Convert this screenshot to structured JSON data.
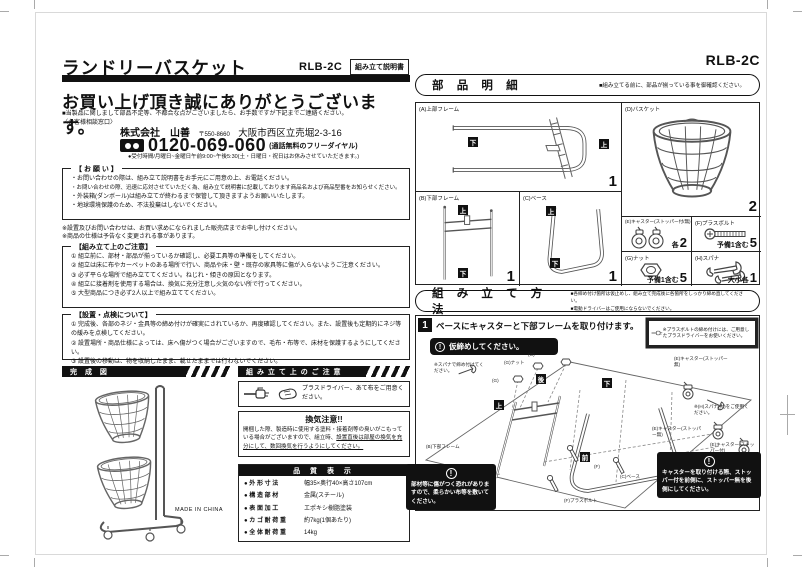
{
  "left": {
    "header": {
      "title": "ランドリーバスケット",
      "model": "RLB-2C",
      "doc_type": "組み立て説明書"
    },
    "greeting": "お買い上げ頂き誠にありがとうございます。",
    "contact": {
      "lead": "■当製品に関しまして部品不足等、不都合な点がございましたら、お手数ですが下記までご連絡ください。",
      "window": "〈お客様相談窓口〉",
      "company": "株式会社　山善",
      "postal": "〒550-8660",
      "address": "大阪市西区立売堀2-3-16",
      "phone": "0120-069-060",
      "phone_note": "(通話無料のフリーダイヤル)",
      "hours": "●受付時間/月曜日~金曜日午前9:00~午後5:30(土・日曜日・祝日はお休みさせていただきます。)"
    },
    "request_box": {
      "title": "【 お 願 い 】",
      "items": [
        "・お問い合わせの際は、組み立て説明書をお手元にご用意の上、お電話ください。",
        "・お問い合わせの際、迅速に応対させていただく為、組み立て説明書に記載しております商品名および商品型番をお知らせください。",
        "・外装箱(ダンボール)は組み立てが終わるまで保管して頂きますようお願いいたします。",
        "・地球環境保護のため、不法投棄はしないでください。"
      ]
    },
    "notes": [
      "※設置及びお問い合わせは、お買い求めになられました販売店までお申し付けください。",
      "※商品の仕様は予告なく変更される事があります。"
    ],
    "assembly_caution_box": {
      "title": "【組み立て上のご注意】",
      "items": [
        "① 組立前に、部材・部品が揃っているか確認し、必要工具等の準備をしてください。",
        "② 組立は床に布やカーペットのある場所で行い、商品や床・壁・既存の家具等に傷が入らないようご注意ください。",
        "③ 必ず平らな場所で組み立ててください。ねじれ・傾きの原因となります。",
        "④ 組立に接着剤を使用する場合は、換気に充分注意し火気のない所で行ってください。",
        "⑤ 大型商品につき必ず2人以上で組み立ててください。"
      ]
    },
    "inspection_box": {
      "title": "【設置・点検について】",
      "items": [
        "① 完成後、各部のネジ・金具等の締め付けが確実にされているか、再度確認してください。また、設置後も定期的にネジ等の緩みを点検してください。",
        "② 設置場所・商品仕様によっては、床へ傷がつく場合がございますので、毛布・布等で、床材を保護するようにしてください。",
        "③ 設置後の移動は、物を収納したまま、載せたままでは行わないでください。"
      ]
    },
    "finished": {
      "header": "完 成 図",
      "made_in": "MADE IN CHINA"
    },
    "caution_col": {
      "header": "組 み 立 て 上 の ご 注 意",
      "tools": "プラスドライバー、あて布をご用意ください。",
      "vent_title": "換気注意!!",
      "vent_text1": "開梱した際、製造時に使用する塗料・接着剤等の臭いがこもっている場合がございますので、組立時、",
      "vent_text2": "設置直後は部屋の換気を充分にして、数回換気を行うようにしてください。"
    },
    "quality": {
      "header": "品 質 表 示",
      "rows": [
        {
          "label": "● 外 形 寸 法",
          "value": "幅35×奥行40×高さ107cm"
        },
        {
          "label": "● 構 造 部 材",
          "value": "金属(スチール)"
        },
        {
          "label": "● 表 面 加 工",
          "value": "エポキシ樹脂塗装"
        },
        {
          "label": "● カ ゴ 耐 荷 重",
          "value": "約7kg(1個あたり)"
        },
        {
          "label": "● 全 体 耐 荷 重",
          "value": "14kg"
        }
      ]
    }
  },
  "right": {
    "model": "RLB-2C",
    "parts": {
      "header": "部 品 明 細",
      "note": "■組み立てる前に、部品が揃っている事を御確認ください。",
      "a": {
        "label": "(A)上部フレーム",
        "qty": "1"
      },
      "b": {
        "label": "(B)下部フレーム",
        "qty": "1"
      },
      "c": {
        "label": "(C)ベース",
        "qty": "1"
      },
      "d": {
        "label": "(D)バスケット",
        "qty": "2"
      },
      "e": {
        "label": "(E)キャスター(ストッパー付/無)",
        "qty_prefix": "各",
        "qty": "2"
      },
      "f": {
        "label": "(F)プラスボルト",
        "qty_prefix": "予備1含む",
        "qty": "5"
      },
      "g": {
        "label": "(G)ナット",
        "qty_prefix": "予備1含む",
        "qty": "5"
      },
      "h": {
        "label": "(H)スパナ",
        "qty_prefix": "大小各",
        "qty": "1"
      }
    },
    "assembly": {
      "header": "組 み 立 て 方 法",
      "note1": "■各締め付け箇所は仮止めし、組み立て完成後に各箇所をしっかり締め直してください。",
      "note2": "■電動ドライバーはご使用にならないでください。",
      "step1": {
        "num": "1",
        "title": "ベースにキャスターと下部フレームを取り付けます。",
        "warn": "仮締めしてください。",
        "tool_note": "※プラスボルトの締め付けには、ご用意したプラスドライバーをお使いください。",
        "labels": {
          "spanner_note": "※スパナで締め付けてください。",
          "nut": "(G)ナット",
          "g": "(G)",
          "f": "(F)",
          "caster_free1": "(E)キャスター(ストッパー無)",
          "spanner_large_note": "※(H)スパナ(大)をご使用ください。",
          "caster_free2": "(E)キャスター(ストッパー無)",
          "caster_stop": "(E)キャスター(ストッパー付)",
          "lower_frame": "(B)下部フレーム",
          "base": "(C)ベース",
          "bolt": "(F)プラスボルト"
        },
        "caution_left": "部材等に傷がつく恐れがありますので、柔らかい布等を敷いてください。",
        "caution_right": "キャスターを取り付ける際、ストッパー付を前側に、ストッパー無を後側にしてください。"
      }
    }
  },
  "markers": {
    "top": "上",
    "bottom": "下",
    "front": "前",
    "back": "後"
  },
  "icons": {
    "exclamation": "!"
  }
}
